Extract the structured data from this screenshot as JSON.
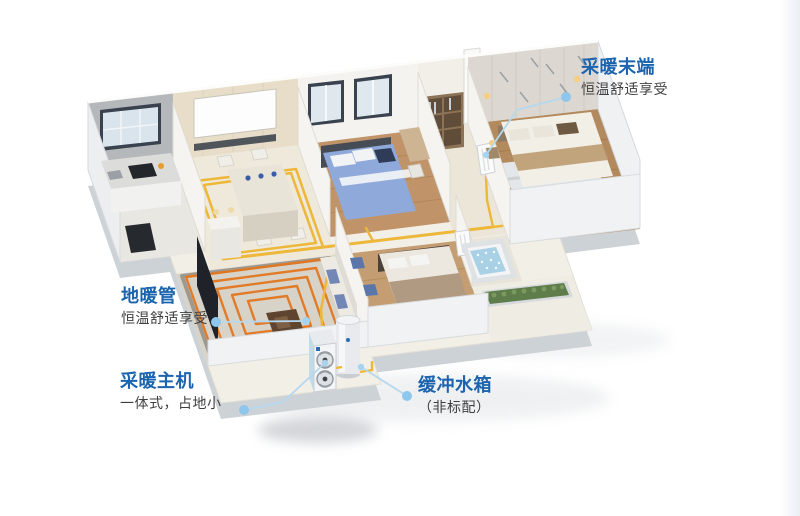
{
  "diagram_title": "",
  "callouts": [
    {
      "id": "heating-terminal",
      "title": "采暖末端",
      "subtitle": "恒温舒适享受"
    },
    {
      "id": "floor-heating-pipe",
      "title": "地暖管",
      "subtitle": "恒温舒适享受"
    },
    {
      "id": "heating-main-unit",
      "title": "采暖主机",
      "subtitle": "一体式，占地小"
    },
    {
      "id": "buffer-tank",
      "title": "缓冲水箱",
      "subtitle": "（非标配）"
    }
  ],
  "colors": {
    "callout_title_blue": "#1c64ae",
    "callout_subtitle_gray": "#3f3f3f",
    "leader_line_blue": "#b5d8ef",
    "leader_dot_blue": "#8fc6eb",
    "supply_pipe_yellow": "#f0c03c",
    "floor_coil_orange": "#e2761f",
    "jacuzzi_water_blue": "#a9d1e6",
    "wood_floor": "#bf9668",
    "plinth_gray": "#cdd2d7"
  },
  "scene": {
    "type": "isometric-apartment-cutaway",
    "parts": [
      "kitchen",
      "dining-room",
      "bedroom-with-blue-bed",
      "hallway-wardrobe",
      "wall-radiator",
      "master-bedroom",
      "living-room",
      "floor-heating-coil",
      "second-bedroom",
      "jacuzzi-tub",
      "balcony-planter",
      "heat-pump-outdoor-unit",
      "buffer-tank-cylinder",
      "yellow-supply-pipes"
    ]
  }
}
